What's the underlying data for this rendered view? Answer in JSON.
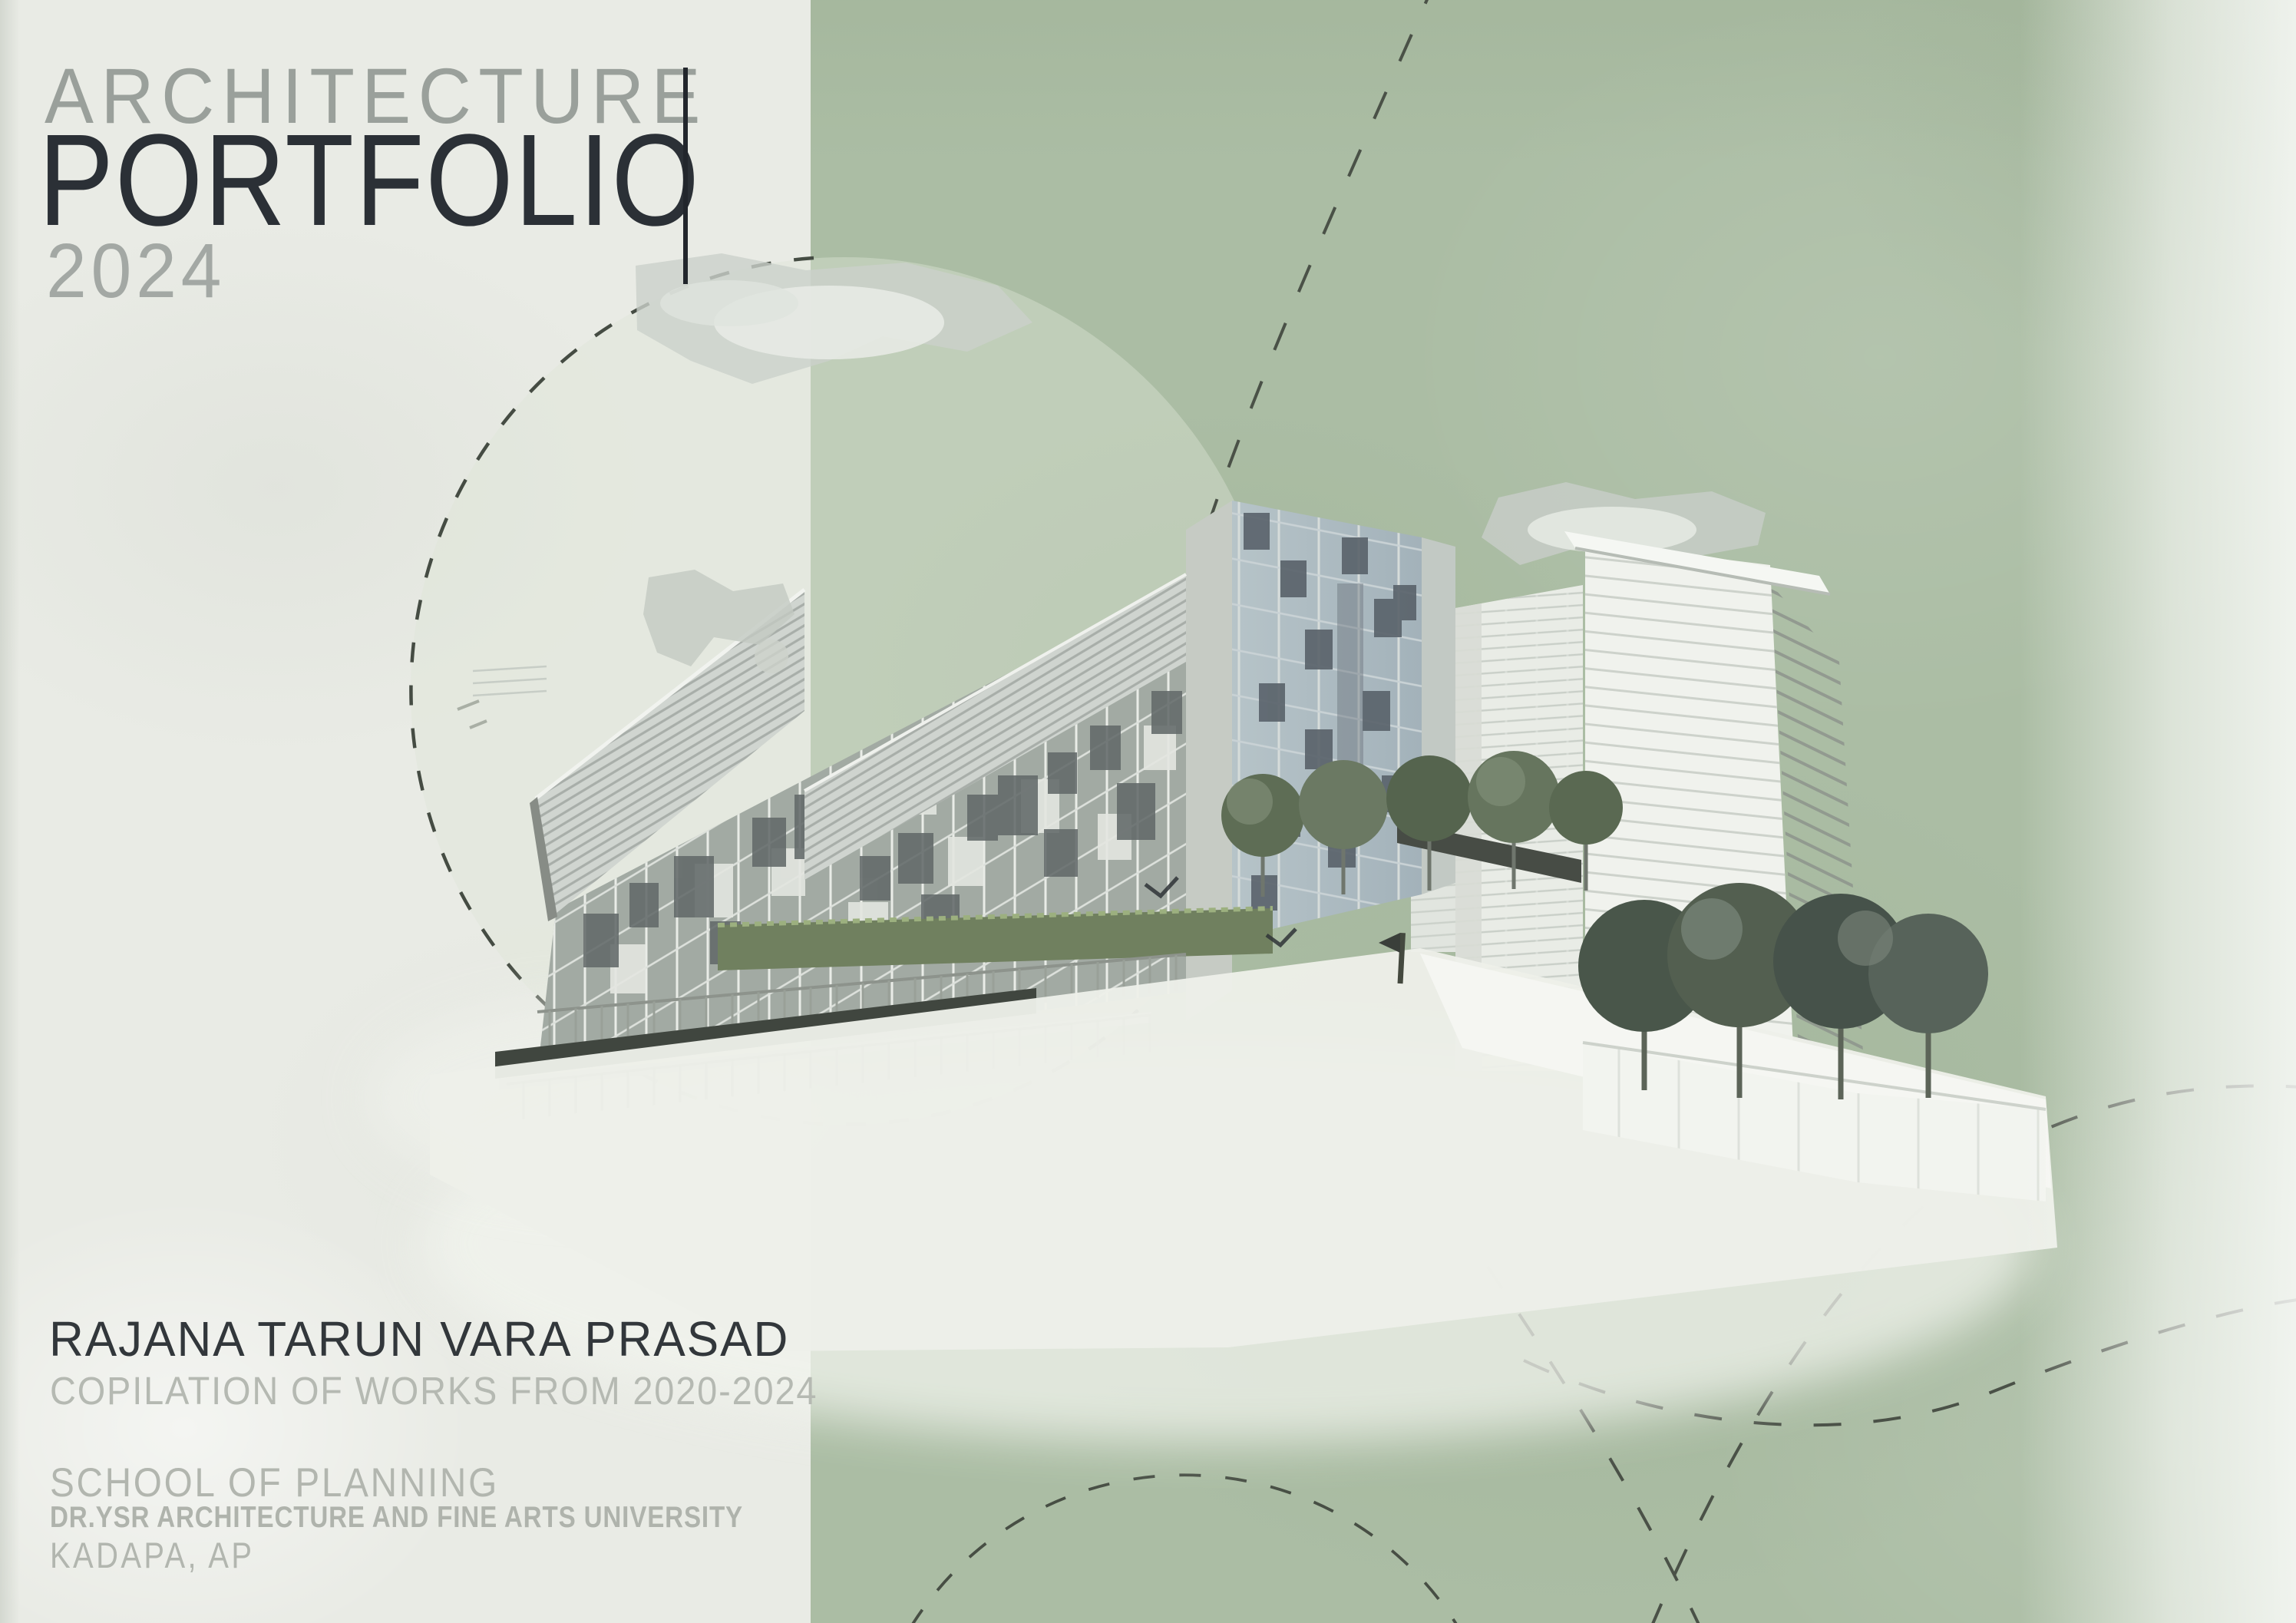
{
  "page": {
    "background_left_color": "#e9ebe5",
    "background_right_color": "#abbda4",
    "dash_color": "#454c43"
  },
  "title_block": {
    "kicker": "ARCHITECTURE",
    "title": "PORTFOLIO",
    "year": "2024",
    "kicker_color": "#9aa09b",
    "title_color": "#2b3036",
    "year_color": "#a3a8a4",
    "accent_bar_color": "#22262c"
  },
  "author_block": {
    "name": "RAJANA TARUN VARA PRASAD",
    "works_range": "COPILATION OF WORKS FROM 2020-2024",
    "name_color": "#32373b",
    "muted_color": "#b5b9b2"
  },
  "institution_block": {
    "school": "SCHOOL OF PLANNING",
    "university": "DR.YSR ARCHITECTURE AND FINE ARTS UNIVERSITY",
    "location": "KADAPA, AP"
  },
  "artwork": {
    "description": "Greyscale architectural render of a modern glass complex with a slanted louvered facade band, glass curtain walls, two white residential towers, trees and plaza, over a sage-green panel with dashed decorative circles and curves"
  }
}
